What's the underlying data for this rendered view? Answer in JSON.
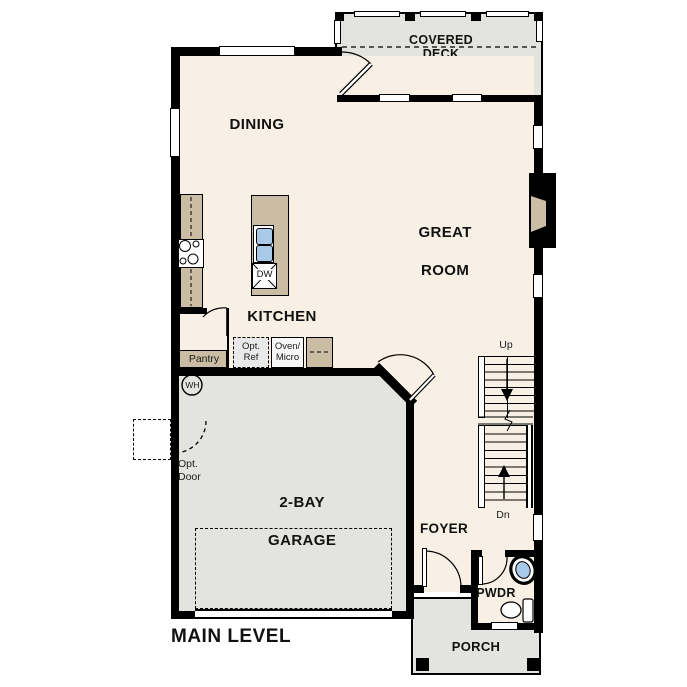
{
  "title": "MAIN LEVEL",
  "rooms": {
    "covered_deck": {
      "line1": "COVERED",
      "line2": "DECK"
    },
    "dining": {
      "label": "DINING"
    },
    "great_room": {
      "line1": "GREAT",
      "line2": "ROOM"
    },
    "kitchen": {
      "label": "KITCHEN"
    },
    "garage": {
      "line1": "2-BAY",
      "line2": "GARAGE"
    },
    "foyer": {
      "label": "FOYER"
    },
    "powder": {
      "label": "PWDR"
    },
    "porch": {
      "label": "PORCH"
    }
  },
  "fixtures": {
    "dishwasher": "DW",
    "water_heater": "WH",
    "pantry": "Pantry",
    "opt_ref": {
      "line1": "Opt.",
      "line2": "Ref"
    },
    "oven_micro": {
      "line1": "Oven/",
      "line2": "Micro"
    },
    "opt_door": {
      "line1": "Opt.",
      "line2": "Door"
    }
  },
  "stairs": {
    "up": "Up",
    "down": "Dn"
  },
  "colors": {
    "interior_floor": "#f8f0e4",
    "exterior_floor": "#e3e3e0",
    "counter_tan": "#cbbda4",
    "sink_blue": "#a9c9e9",
    "wall": "#000000",
    "background": "#ffffff"
  }
}
